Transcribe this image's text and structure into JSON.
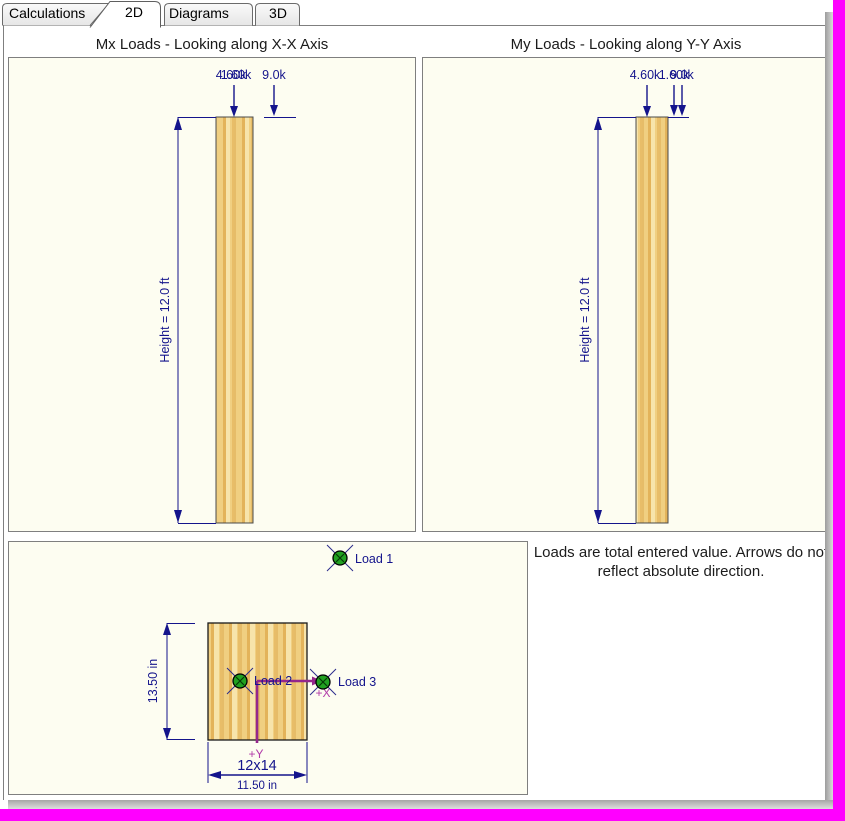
{
  "tabs": {
    "items": [
      {
        "label": "Calculations",
        "active": false
      },
      {
        "label": "2D",
        "active": true
      },
      {
        "label": "Diagrams",
        "active": false
      },
      {
        "label": "3D",
        "active": false
      }
    ]
  },
  "mx_panel": {
    "title": "Mx Loads - Looking along X-X Axis",
    "height_label": "Height = 12.0 ft",
    "load_labels": [
      "4.60k",
      "1.60k",
      "9.0k"
    ]
  },
  "my_panel": {
    "title": "My Loads - Looking along Y-Y Axis",
    "height_label": "Height = 12.0 ft",
    "load_labels": [
      "4.60k",
      "1.60k",
      "9.0k"
    ]
  },
  "plan_panel": {
    "section_size_label": "12x14",
    "width_label": "11.50 in",
    "depth_label": "13.50 in",
    "axis_labels": {
      "x": "+X",
      "y": "+Y"
    },
    "loads": [
      {
        "label": "Load 1"
      },
      {
        "label": "Load 2"
      },
      {
        "label": "Load 3"
      }
    ]
  },
  "note": {
    "text": "Loads are total entered value. Arrows do not reflect absolute direction."
  },
  "colors": {
    "accent_navy": "#14148C",
    "magenta_frame": "#FF00FF",
    "axis_magenta": "#94278C",
    "marker_green": "#21A121",
    "panel_bg": "#FDFDF1",
    "wood_base": "#F0CF81"
  }
}
